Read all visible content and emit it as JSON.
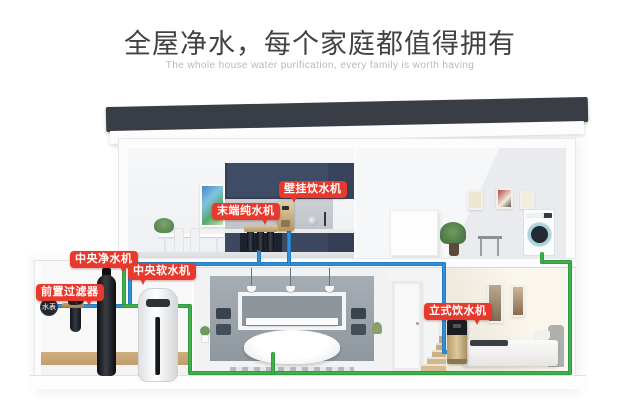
{
  "header": {
    "title": "全屋净水，每个家庭都值得拥有",
    "subtitle": "The whole house water purification, every family is worth having"
  },
  "callouts": {
    "wall_dispenser": {
      "label": "壁挂饮水机"
    },
    "terminal_purifier": {
      "label": "末端纯水机"
    },
    "central_purifier": {
      "label": "中央净水机"
    },
    "central_softener": {
      "label": "中央软水机"
    },
    "pre_filter": {
      "label": "前置过滤器"
    },
    "floor_dispenser": {
      "label": "立式饮水机"
    },
    "water_meter": {
      "label": "水表"
    }
  },
  "colors": {
    "callout_bg": "#e83a2c",
    "pipe_mains_blue": "#2f8fd8",
    "pipe_soft_green": "#3fb04b",
    "roof": "#383d46",
    "kitchen_cabinet": "#3f4c66",
    "device_gold": "#c4a97c",
    "wood_baseboard": "#c9a877"
  }
}
